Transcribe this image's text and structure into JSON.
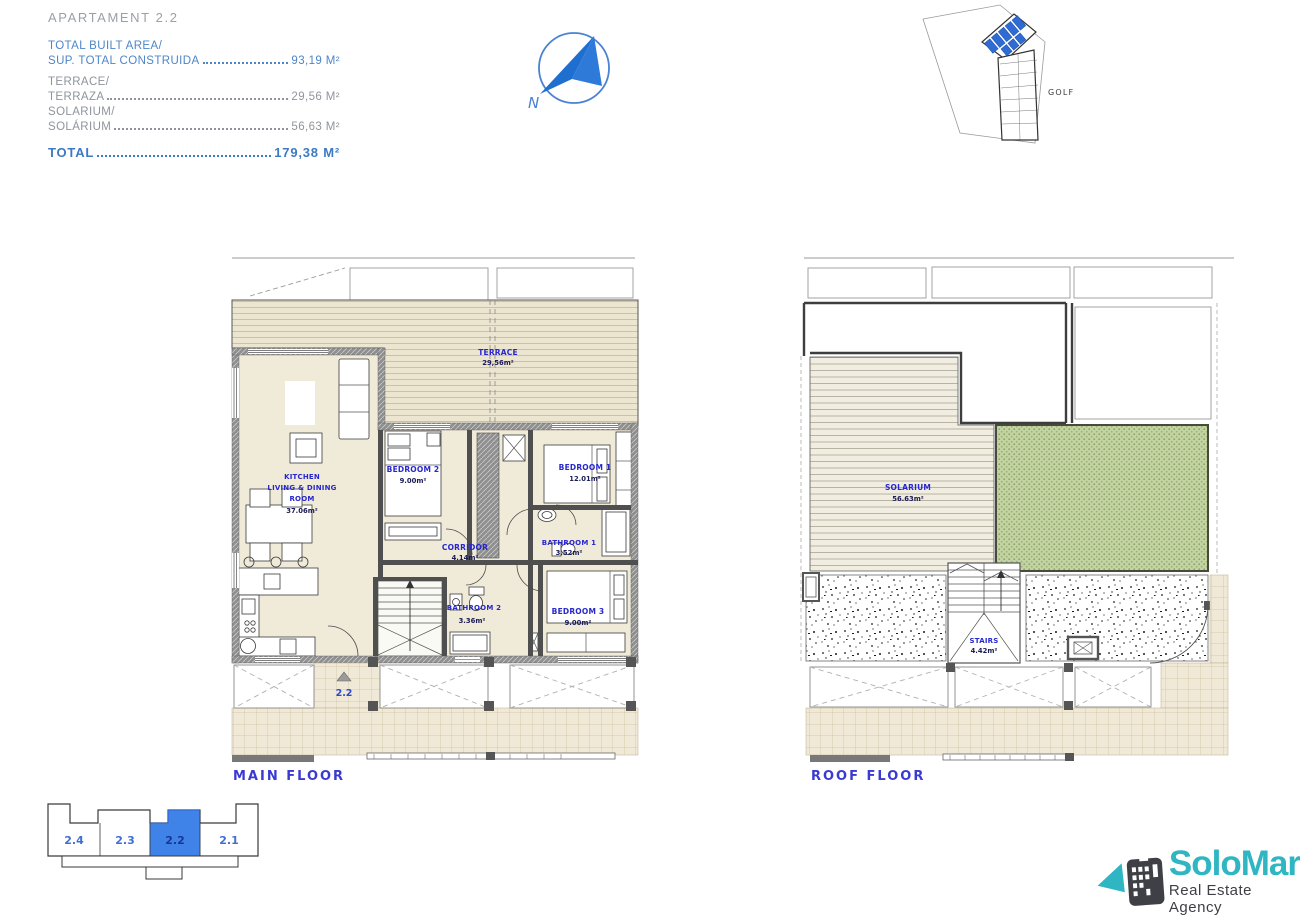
{
  "summary": {
    "title": "APARTAMENT 2.2",
    "items": [
      {
        "line1": "TOTAL BUILT AREA/",
        "line2": "SUP. TOTAL CONSTRUIDA",
        "value": "93,19 M²"
      },
      {
        "line1": "TERRACE/",
        "line2": "TERRAZA",
        "value": "29,56 M²"
      },
      {
        "line1": "SOLARIUM/",
        "line2": "SOLÁRIUM",
        "value": "56,63 M²"
      }
    ],
    "total_label": "TOTAL",
    "total_value": "179,38 M²"
  },
  "compass": {
    "north_letter": "N"
  },
  "site_plan": {
    "area_label": "GOLF"
  },
  "main_floor": {
    "title": "MAIN FLOOR",
    "entrance_marker": "2.2",
    "rooms": {
      "terrace": {
        "name": "TERRACE",
        "area": "29,56m²"
      },
      "kitchen": {
        "line1": "KITCHEN",
        "line2": "LIVING & DINING",
        "line3": "ROOM",
        "area": "37.06m²"
      },
      "bedroom2": {
        "name": "BEDROOM 2",
        "area": "9.00m²"
      },
      "bedroom1": {
        "name": "BEDROOM 1",
        "area": "12.01m²"
      },
      "corridor": {
        "name": "CORRIDOR",
        "area": "4.14m²"
      },
      "bathroom1": {
        "name": "BATHROOM 1",
        "area": "3.52m²"
      },
      "bathroom2": {
        "name": "BATHROOM 2",
        "area": "3.36m²"
      },
      "bedroom3": {
        "name": "BEDROOM 3",
        "area": "9.00m²"
      }
    }
  },
  "roof_floor": {
    "title": "ROOF FLOOR",
    "rooms": {
      "solarium": {
        "name": "SOLARIUM",
        "area": "56.63m²"
      },
      "stairs": {
        "name": "STAIRS",
        "area": "4.42m²"
      }
    }
  },
  "unit_selector": {
    "units": [
      {
        "label": "2.4"
      },
      {
        "label": "2.3"
      },
      {
        "label": "2.2"
      },
      {
        "label": "2.1"
      }
    ],
    "selected": "2.2"
  },
  "logo": {
    "brand": "SoloMar",
    "tagline": "Real Estate Agency"
  },
  "colors": {
    "summary_blue": "#4d86c8",
    "summary_gray": "#8f949c",
    "plan_label_blue": "#2727ce",
    "floor_title_blue": "#3a3ad2",
    "unit_highlight_blue": "#3f83e8",
    "compass_blue": "#2273cf",
    "terrace_deck": "#ece5cf",
    "solarium_green": "#c3d4a2",
    "logo_teal": "#2fb6c2",
    "logo_dark": "#3f4046"
  }
}
